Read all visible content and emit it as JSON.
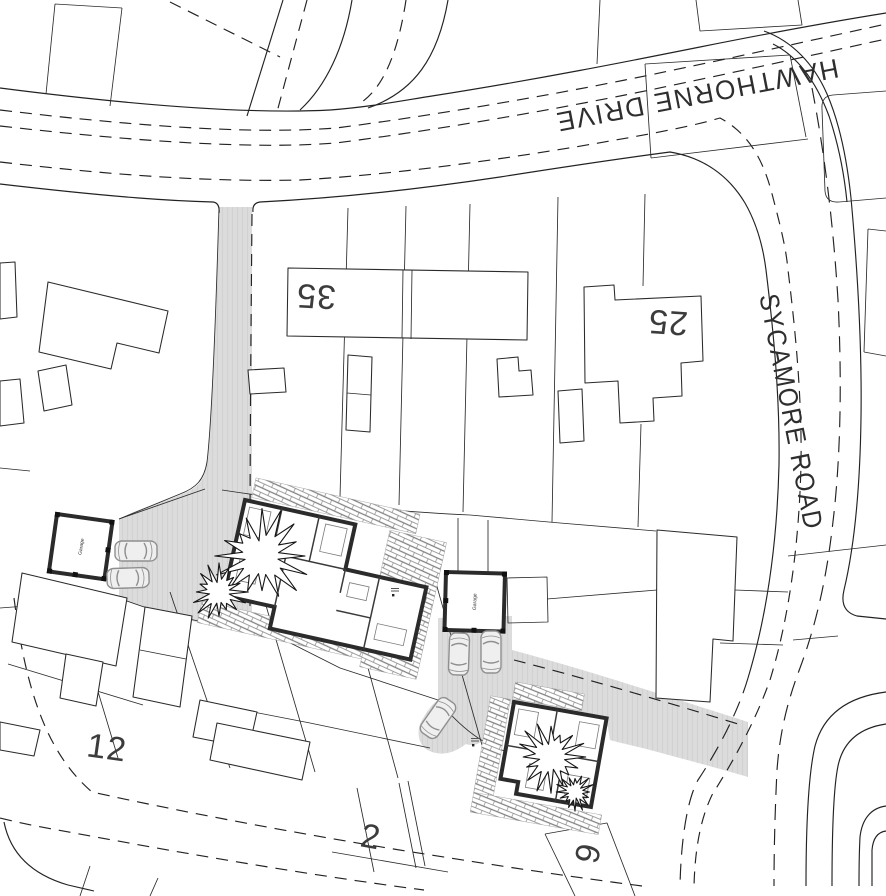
{
  "roads": {
    "hawthorne": "HAWTHORNE DRIVE",
    "sycamore": "SYCAMORE ROAD"
  },
  "house_numbers": {
    "n35": "35",
    "n25": "25",
    "n12": "12",
    "n2": "2",
    "n6": "6"
  },
  "outbuildings": {
    "garage_label": "Garage"
  },
  "colors": {
    "background": "#ffffff",
    "line": "#222222",
    "plot_line": "#2a2a2a",
    "wall": "#2b2b2b",
    "driveway_fill": "#dcdcdc",
    "driveway_stripe": "#d2d2d2",
    "hatch_line": "#808080",
    "car_stroke": "#8f8f8f",
    "label_text": "#3c3c3c"
  }
}
